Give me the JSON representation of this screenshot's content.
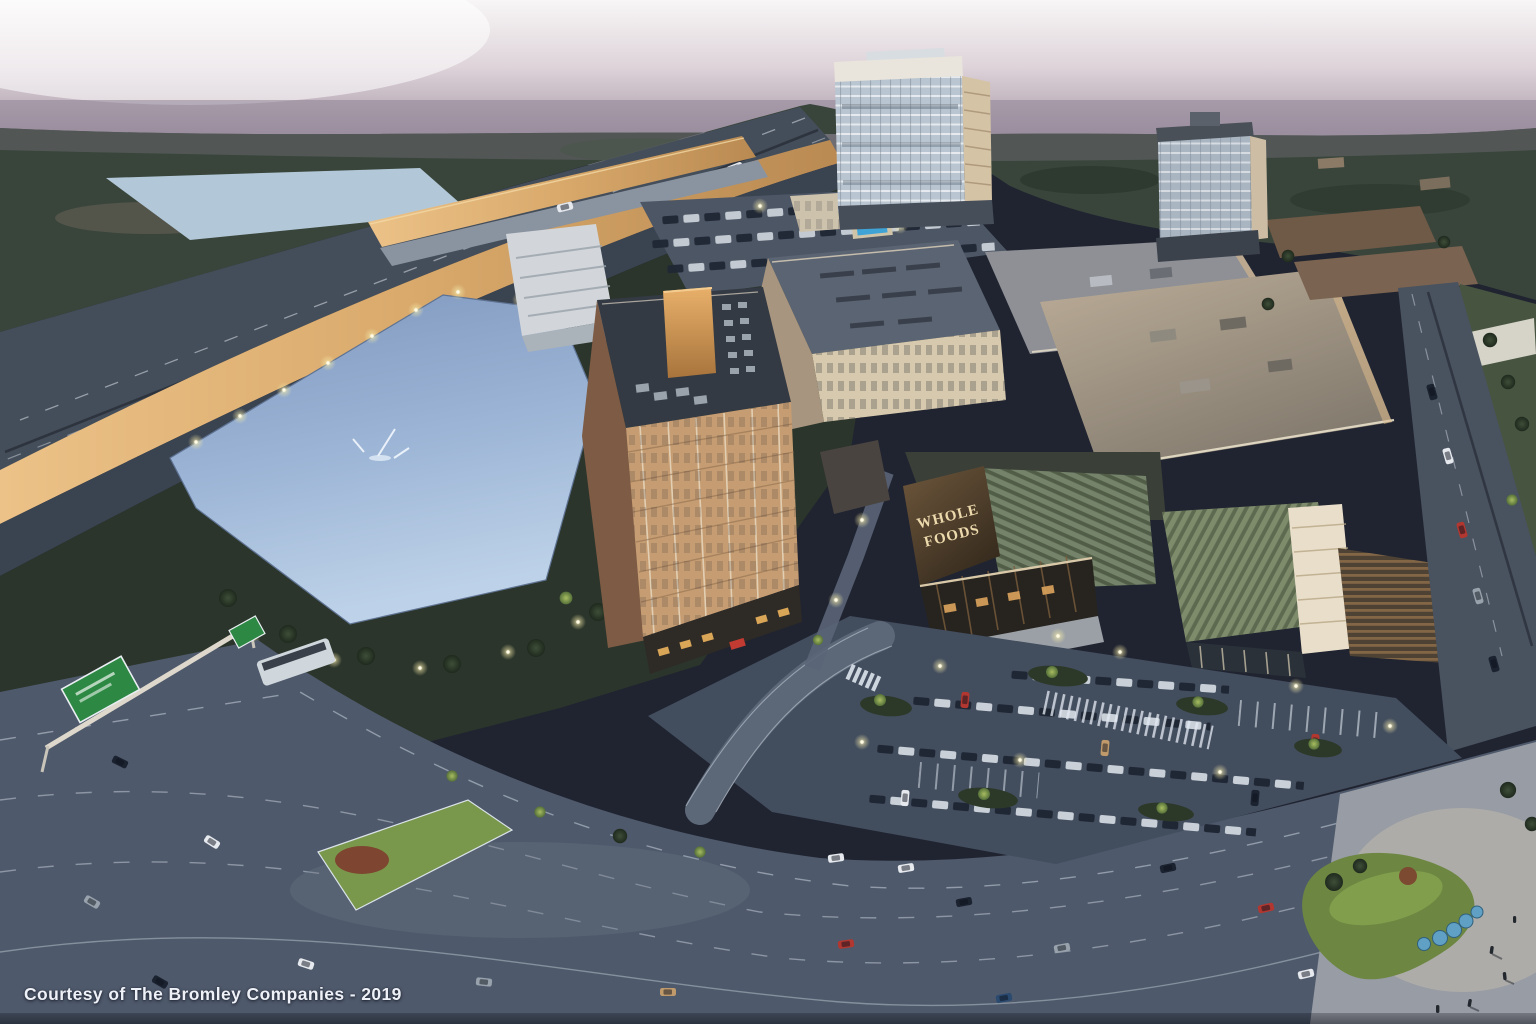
{
  "meta": {
    "type": "aerial-architectural-rendering",
    "time_of_day": "dusk",
    "subject": "mixed-use development with lake, office towers, apartments, Whole Foods anchor store, parking garages and arterial roads"
  },
  "caption": {
    "text": "Courtesy of The Bromley Companies - 2019"
  },
  "signs": {
    "whole_foods": {
      "line1": "WHOLE",
      "line2": "FOODS"
    }
  },
  "palette": {
    "sky_top": "#f7f5f6",
    "sky_haze": "#948a9b",
    "forest": "#39453b",
    "lake": "#b2c8d8",
    "pond_dark": "#7e97bd",
    "pond_light": "#bdd2e8",
    "highway_asphalt": "#444e5b",
    "sound_wall_tan": "#d9a96b",
    "road": "#4e596b",
    "parking": "#424d5e",
    "tower_glass": "#b9c5d0",
    "tower_sunlit": "#d5c3a6",
    "hotel_facade": "#c69d72",
    "hotel_roof": "#333a43",
    "roof_orange": "#d79a58",
    "apartment_tan": "#d6c9ad",
    "retail_roof": "#b7a894",
    "whole_foods_brown": "#4a3a28",
    "sign_cream": "#ecd9ac",
    "louver_green": "#75836a",
    "grass_lit": "#79984c",
    "highway_sign_green": "#2d8843",
    "sculpture_blue": "#5fa0c4",
    "streetlight": "#f5edba"
  }
}
